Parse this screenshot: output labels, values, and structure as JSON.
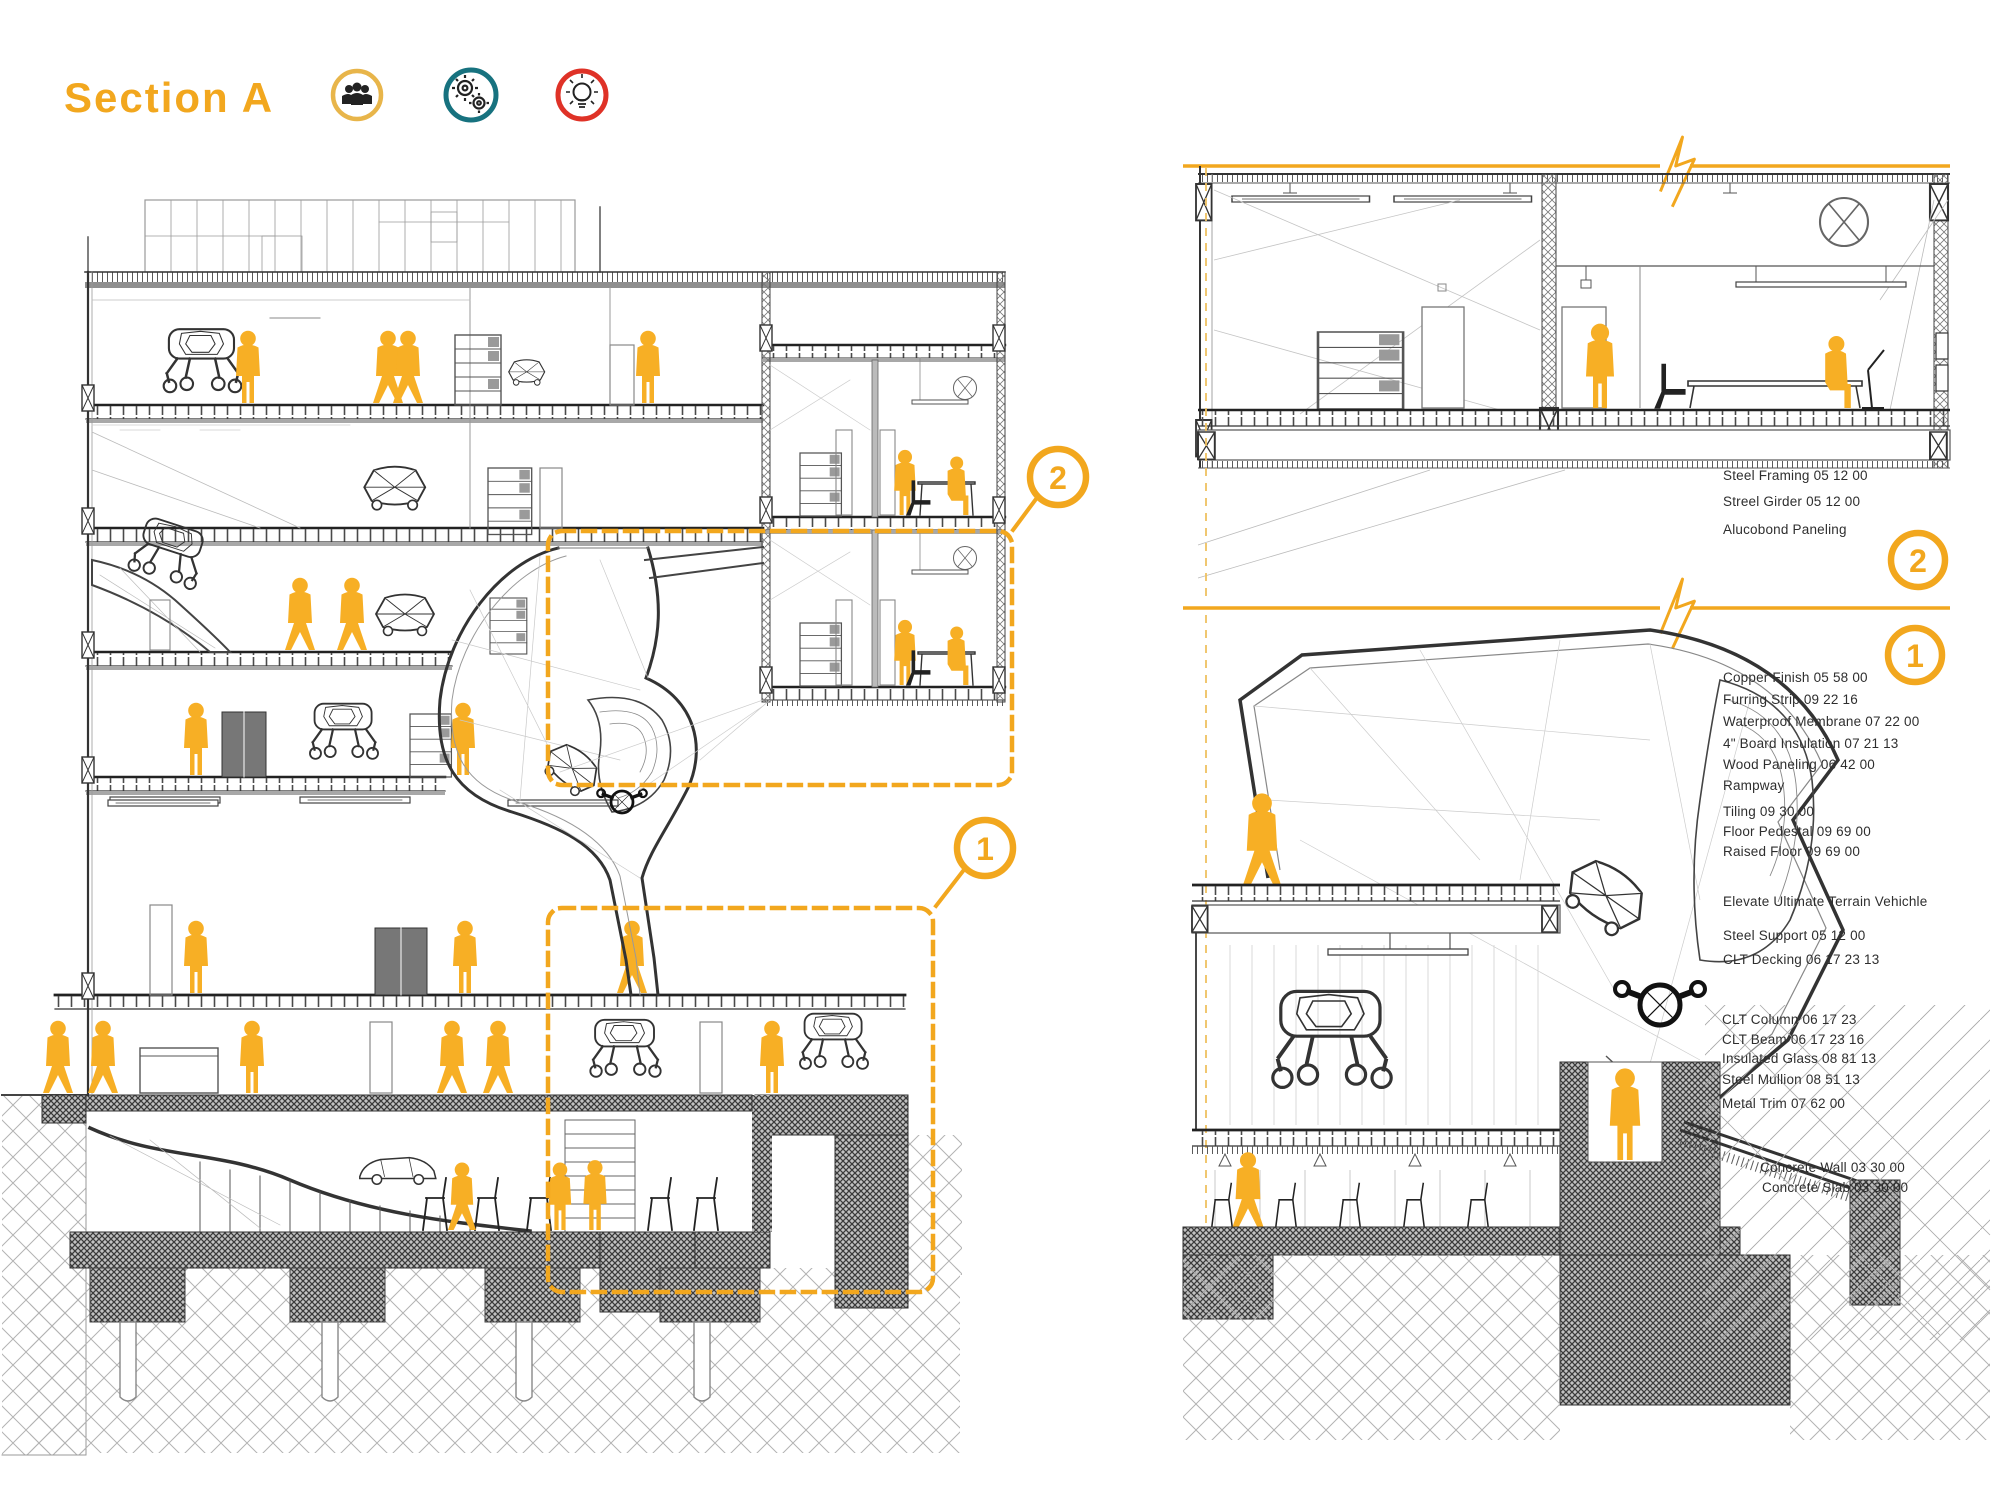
{
  "title": "Section A",
  "colors": {
    "accent": "#F2A71E",
    "figure": "#F7AF25",
    "teal": "#17727F",
    "red": "#DF3227",
    "ink": "#3a3a3a"
  },
  "icons": [
    {
      "name": "team-icon",
      "ring": "#E8B54A"
    },
    {
      "name": "gears-icon",
      "ring": "#17727F"
    },
    {
      "name": "idea-icon",
      "ring": "#DF3227"
    }
  ],
  "callouts": {
    "c1": "1",
    "c2": "2"
  },
  "annotations": {
    "d2": [
      "Steel Framing 05 12 00",
      "Streel Girder 05 12 00",
      "Alucobond Paneling"
    ],
    "d1_envelope": [
      "Copper Finish 05 58 00",
      "Furring Strip 09 22 16",
      "Waterproof Membrane 07 22 00",
      "4\" Board Insulation 07 21 13",
      "Wood Paneling 06 42 00",
      "Rampway"
    ],
    "d1_floor": [
      "Tiling 09 30 00",
      "Floor Pedestal 09 69 00",
      "Raised Floor 09 69 00"
    ],
    "d1_vehicle": "Elevate Ultimate Terrain Vehichle",
    "d1_structure": [
      "Steel Support 05 12 00",
      "CLT Decking 06 17 23 13"
    ],
    "d1_frame": [
      "CLT Column 06 17 23",
      "CLT Beam 06 17 23 16",
      "Insulated Glass 08 81 13",
      "Steel Mullion 08 51 13",
      "Metal Trim 07 62 00"
    ],
    "d1_concrete": [
      "Concrete Wall 03 30 00",
      "Concrete Slab 03 30 00"
    ]
  }
}
